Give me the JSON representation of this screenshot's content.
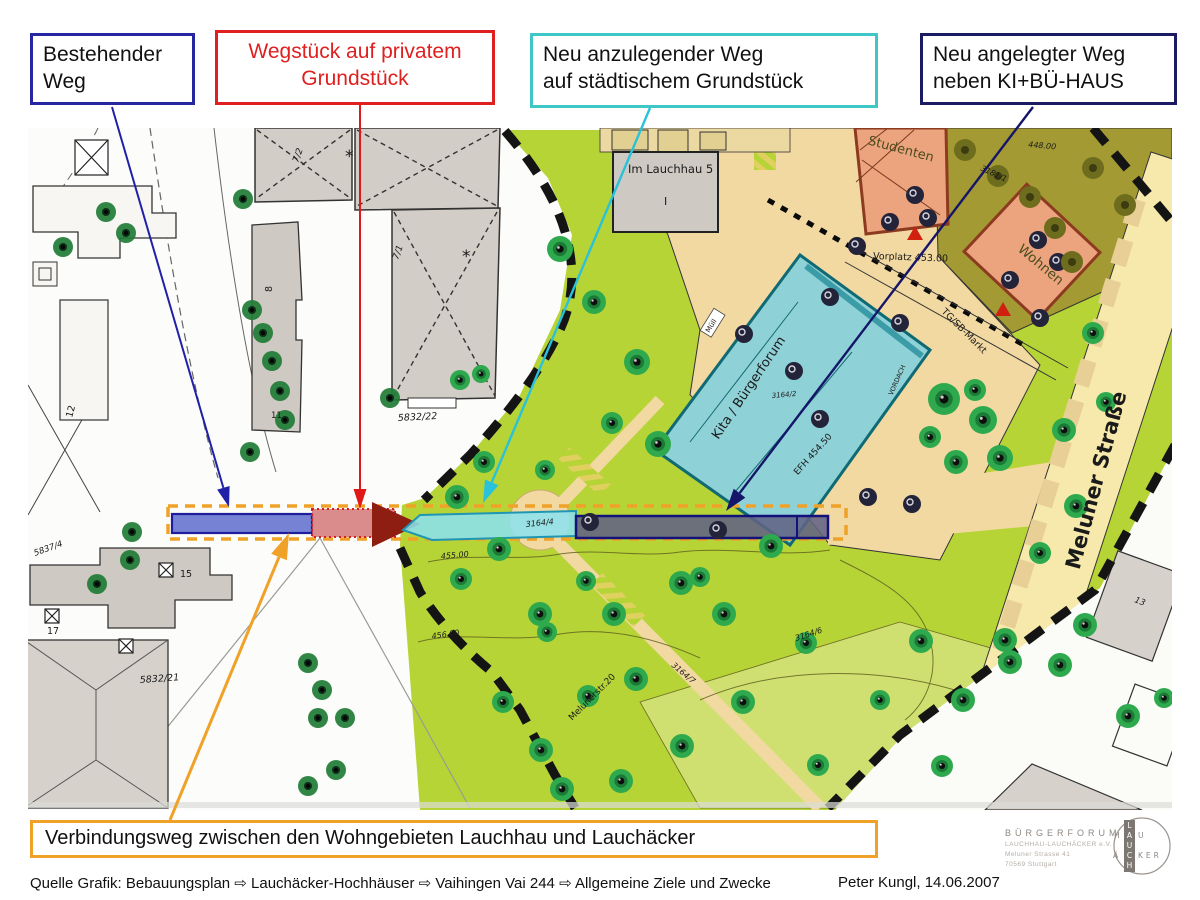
{
  "callouts": {
    "existing": {
      "line1": "Bestehender",
      "line2": "Weg"
    },
    "private": {
      "line1": "Wegstück auf privatem",
      "line2": "Grundstück"
    },
    "new_city": {
      "line1": "Neu anzulegender Weg",
      "line2": "auf städtischem Grundstück"
    },
    "new_kibu": {
      "line1": "Neu angelegter Weg",
      "line2": "neben KI+BÜ-HAUS"
    },
    "bottom": {
      "label": "Verbindungsweg zwischen den Wohngebieten Lauchhau und Lauchäcker"
    }
  },
  "footer": {
    "source": "Quelle Grafik: Bebauungsplan ⇨ Lauchäcker-Hochhäuser ⇨  Vaihingen Vai 244 ⇨ Allgemeine Ziele und Zwecke",
    "author": "Peter Kungl, 14.06.2007"
  },
  "logo": {
    "title": "BÜRGERFORUM",
    "org": "LAUCHHAU-LAUCHÄCKER e.V.",
    "street": "Meluner Strasse 41",
    "city": "70569 Stuttgart",
    "cross_vertical": "LAUCH",
    "cross_top_left": "H",
    "cross_top_right": "U",
    "cross_bottom_left": "Ä",
    "cross_bottom_right": "KER"
  },
  "colors": {
    "callout_existing_border": "#2626a0",
    "callout_private": "#e01f1f",
    "callout_city_border": "#3fc6c6",
    "callout_kibu_border": "#1b1b63",
    "bottom_border": "#f0a128",
    "arrow_existing": "#2121a8",
    "arrow_private": "#e01818",
    "arrow_city": "#29c2da",
    "arrow_kibu": "#15156a",
    "arrow_bottom": "#f0a128"
  },
  "map": {
    "corridor": {
      "outline": {
        "x": 168,
        "y": 506,
        "w": 678,
        "h": 33,
        "color": "#f0a128"
      },
      "segments": [
        {
          "name": "existing-way-segment",
          "shape": "rect",
          "x": 172,
          "y": 514,
          "w": 140,
          "h": 19,
          "fill": "rgba(80,95,200,0.78)",
          "stroke": "#1d1d9e",
          "sw": 2.2
        },
        {
          "name": "private-way-segment",
          "shape": "rect",
          "x": 312,
          "y": 509,
          "w": 83,
          "h": 28,
          "fill": "rgba(205,95,95,0.72)",
          "stroke": "#d42020",
          "sw": 2,
          "dotted": true
        },
        {
          "name": "private-way-arrowhead",
          "shape": "poly",
          "points": "372,502 420,524 372,547",
          "fill": "#8e1d12"
        },
        {
          "name": "new-city-way-segment",
          "shape": "poly",
          "points": "403,530 420,515 576,511 576,536 432,540",
          "fill": "rgba(140,225,238,0.88)",
          "stroke": "#1f96b4",
          "sw": 2
        },
        {
          "name": "new-kibu-way-segment",
          "shape": "rect",
          "x": 576,
          "y": 516,
          "w": 252,
          "h": 22,
          "fill": "rgba(98,98,132,0.88)",
          "stroke": "#12127a",
          "sw": 2.5
        }
      ]
    },
    "arrows": [
      {
        "name": "existing-way-pointer",
        "color": "#2121a8",
        "from": [
          112,
          107
        ],
        "to": [
          229,
          507
        ],
        "w": 2
      },
      {
        "name": "private-way-pointer",
        "color": "#e01818",
        "from": [
          360,
          105
        ],
        "to": [
          360,
          509
        ],
        "w": 2
      },
      {
        "name": "new-city-way-pointer",
        "color": "#29c2da",
        "from": [
          650,
          108
        ],
        "to": [
          483,
          503
        ],
        "w": 2.4
      },
      {
        "name": "new-kibu-way-pointer",
        "color": "#15156a",
        "from": [
          1033,
          107
        ],
        "to": [
          726,
          511
        ],
        "w": 2.4
      },
      {
        "name": "verbindungsweg-pointer",
        "color": "#f0a128",
        "from": [
          170,
          820
        ],
        "to": [
          289,
          533
        ],
        "w": 3
      }
    ],
    "labels": [
      {
        "t": "Im Lauchhau 5",
        "x": 628,
        "y": 173,
        "s": 11.5
      },
      {
        "t": "I",
        "x": 664,
        "y": 205,
        "s": 11
      },
      {
        "t": "Studenten",
        "x": 900,
        "y": 153,
        "r": 15,
        "s": 13,
        "c": "#4c4c1e",
        "a": "m"
      },
      {
        "t": "Wohnen",
        "x": 1038,
        "y": 268,
        "r": 40,
        "s": 13.5,
        "c": "#4c4c1e",
        "a": "m"
      },
      {
        "t": "3181/1",
        "x": 980,
        "y": 170,
        "r": 25,
        "s": 8,
        "i": 1
      },
      {
        "t": "448.00",
        "x": 1028,
        "y": 147,
        "r": 5,
        "s": 8,
        "i": 1
      },
      {
        "t": "Vorplatz 453.00",
        "x": 873,
        "y": 259,
        "r": 2,
        "s": 9.5
      },
      {
        "t": "TG/SB-Markt",
        "x": 962,
        "y": 333,
        "r": 45,
        "s": 9.5,
        "a": "m"
      },
      {
        "t": "Kita / Bürgerforum",
        "x": 752,
        "y": 390,
        "r": -56,
        "s": 13,
        "a": "m"
      },
      {
        "t": "EFH 454.50",
        "x": 815,
        "y": 456,
        "r": -48,
        "s": 9,
        "a": "m"
      },
      {
        "t": "3164/2",
        "x": 772,
        "y": 398,
        "r": -5,
        "s": 7,
        "i": 1
      },
      {
        "t": "VORDACH",
        "x": 899,
        "y": 381,
        "r": -66,
        "s": 6.5,
        "a": "m"
      },
      {
        "t": "Müll",
        "x": 713,
        "y": 327,
        "r": -58,
        "s": 7,
        "a": "m"
      },
      {
        "t": "Meluner Straße",
        "x": 1103,
        "y": 482,
        "r": -75,
        "s": 21,
        "a": "m",
        "w": 600
      },
      {
        "t": "Melunerstr.20",
        "x": 594,
        "y": 699,
        "r": -45,
        "s": 9,
        "a": "m"
      },
      {
        "t": "3164/7",
        "x": 671,
        "y": 666,
        "r": 40,
        "s": 8,
        "i": 1
      },
      {
        "t": "3164/4",
        "x": 526,
        "y": 527,
        "r": -6,
        "s": 8,
        "i": 1
      },
      {
        "t": "3164/6",
        "x": 796,
        "y": 641,
        "r": -18,
        "s": 8,
        "i": 1
      },
      {
        "t": "455.00",
        "x": 441,
        "y": 559,
        "r": -5,
        "s": 8,
        "i": 1
      },
      {
        "t": "456.00",
        "x": 432,
        "y": 639,
        "r": -8,
        "s": 8,
        "i": 1
      },
      {
        "t": "5832/22",
        "x": 398,
        "y": 421,
        "r": -3,
        "s": 9.5,
        "i": 1
      },
      {
        "t": "5832/21",
        "x": 140,
        "y": 683,
        "r": -4,
        "s": 9.5,
        "i": 1
      },
      {
        "t": "5837/4",
        "x": 35,
        "y": 556,
        "r": -20,
        "s": 8.5,
        "i": 1
      },
      {
        "t": "15",
        "x": 180,
        "y": 577,
        "s": 9.5
      },
      {
        "t": "17",
        "x": 47,
        "y": 634,
        "s": 9.5
      },
      {
        "t": "12",
        "x": 72,
        "y": 418,
        "r": -75,
        "s": 9.5
      },
      {
        "t": "11",
        "x": 271,
        "y": 418,
        "s": 8.5
      },
      {
        "t": "8",
        "x": 272,
        "y": 292,
        "r": -90,
        "s": 9.5
      },
      {
        "t": "13",
        "x": 1134,
        "y": 602,
        "r": 20,
        "s": 8.5,
        "i": 1
      },
      {
        "t": "7/2",
        "x": 298,
        "y": 163,
        "r": -70,
        "s": 9,
        "i": 1
      },
      {
        "t": "7/1",
        "x": 398,
        "y": 260,
        "r": -70,
        "s": 9,
        "i": 1
      },
      {
        "t": "*",
        "x": 345,
        "y": 162,
        "s": 17
      },
      {
        "t": "*",
        "x": 462,
        "y": 262,
        "s": 17
      }
    ],
    "trees": {
      "park": [
        [
          560,
          249,
          13
        ],
        [
          594,
          302,
          12
        ],
        [
          637,
          362,
          13
        ],
        [
          658,
          444,
          13
        ],
        [
          612,
          423,
          11
        ],
        [
          545,
          470,
          10
        ],
        [
          484,
          462,
          11
        ],
        [
          457,
          497,
          12
        ],
        [
          460,
          380,
          10
        ],
        [
          481,
          374,
          9
        ],
        [
          499,
          549,
          12
        ],
        [
          461,
          579,
          11
        ],
        [
          540,
          614,
          12
        ],
        [
          614,
          614,
          12
        ],
        [
          681,
          583,
          12
        ],
        [
          724,
          614,
          12
        ],
        [
          771,
          546,
          12
        ],
        [
          586,
          581,
          10
        ],
        [
          547,
          632,
          10
        ],
        [
          700,
          577,
          10
        ],
        [
          636,
          679,
          12
        ],
        [
          588,
          696,
          11
        ],
        [
          541,
          750,
          12
        ],
        [
          503,
          702,
          11
        ],
        [
          562,
          789,
          12
        ],
        [
          621,
          781,
          12
        ],
        [
          682,
          746,
          12
        ],
        [
          743,
          702,
          12
        ],
        [
          806,
          643,
          11
        ],
        [
          921,
          641,
          12
        ],
        [
          1005,
          640,
          12
        ],
        [
          963,
          700,
          12
        ],
        [
          818,
          765,
          11
        ],
        [
          944,
          399,
          16
        ],
        [
          983,
          420,
          14
        ],
        [
          1000,
          458,
          13
        ],
        [
          956,
          462,
          12
        ],
        [
          930,
          437,
          11
        ],
        [
          975,
          390,
          11
        ],
        [
          1093,
          333,
          11
        ],
        [
          1064,
          430,
          12
        ],
        [
          1106,
          402,
          10
        ],
        [
          1076,
          506,
          12
        ],
        [
          1040,
          553,
          11
        ],
        [
          1085,
          625,
          12
        ],
        [
          1010,
          662,
          12
        ],
        [
          1060,
          665,
          12
        ],
        [
          1128,
          716,
          12
        ],
        [
          1164,
          698,
          10
        ],
        [
          942,
          766,
          11
        ],
        [
          880,
          700,
          10
        ]
      ],
      "dark": [
        [
          857,
          246
        ],
        [
          830,
          297
        ],
        [
          900,
          323
        ],
        [
          744,
          334
        ],
        [
          794,
          371
        ],
        [
          820,
          419
        ],
        [
          590,
          522
        ],
        [
          718,
          530
        ],
        [
          868,
          497
        ],
        [
          912,
          504
        ],
        [
          915,
          195
        ],
        [
          928,
          218
        ],
        [
          890,
          222
        ],
        [
          1038,
          240
        ],
        [
          1058,
          262
        ],
        [
          1010,
          280
        ],
        [
          1040,
          318
        ]
      ],
      "left": [
        [
          106,
          212
        ],
        [
          126,
          233
        ],
        [
          63,
          247
        ],
        [
          243,
          199
        ],
        [
          252,
          310
        ],
        [
          263,
          333
        ],
        [
          272,
          361
        ],
        [
          280,
          391
        ],
        [
          285,
          420
        ],
        [
          250,
          452
        ],
        [
          132,
          532
        ],
        [
          130,
          560
        ],
        [
          97,
          584
        ],
        [
          308,
          663
        ],
        [
          322,
          690
        ],
        [
          318,
          718
        ],
        [
          336,
          770
        ],
        [
          308,
          786
        ],
        [
          390,
          398
        ],
        [
          345,
          718
        ]
      ],
      "olive": [
        [
          965,
          150
        ],
        [
          998,
          176
        ],
        [
          1030,
          197
        ],
        [
          1055,
          228
        ],
        [
          1093,
          168
        ],
        [
          1125,
          205
        ],
        [
          1072,
          262
        ]
      ]
    }
  }
}
